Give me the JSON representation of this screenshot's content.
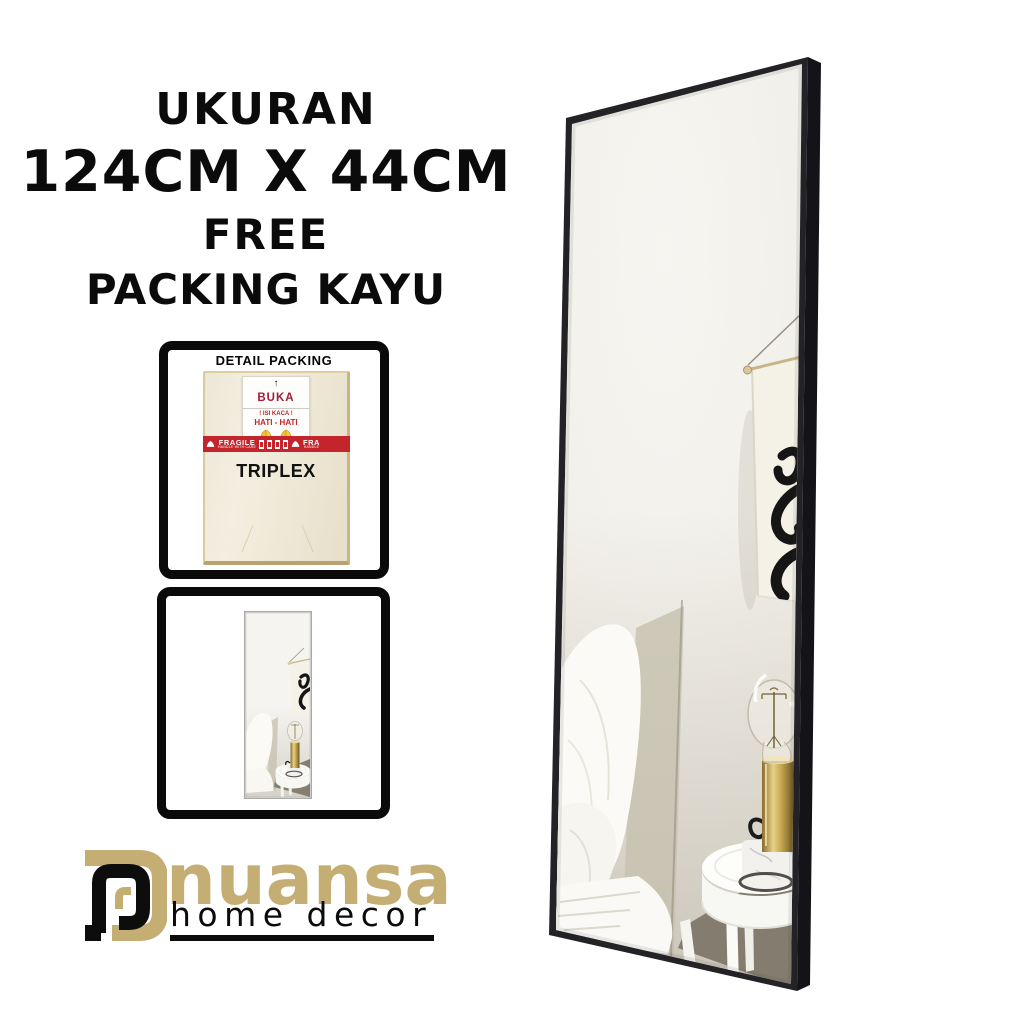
{
  "header": {
    "lines": [
      "UKURAN",
      "124CM X 44CM",
      "FREE",
      "PACKING KAYU"
    ]
  },
  "packing_box": {
    "title": "DETAIL PACKING",
    "label": {
      "arrow": "↑",
      "title": "BUKA",
      "warning_line1": "! ISI KACA !",
      "warning_line2": "HATI - HATI"
    },
    "tape": {
      "text": "FRAGILE",
      "subtext": "HANDLE WITH CARE",
      "repeat_text": "FRA",
      "repeat_subtext": "HANDLE"
    },
    "material_text": "TRIPLEX"
  },
  "logo": {
    "brand": "nuansa",
    "tagline": "home decor"
  },
  "icons": {
    "arrow_up": "arrow-up",
    "praying_hands": "praying-hands"
  },
  "colors": {
    "background": "#FFFFFF",
    "text_black": "#0B0B0B",
    "mirror_frame": "#232327",
    "mirror_wall": "#F2F0EA",
    "logo_gold": "#C4AE74",
    "tape_red": "#C4242B",
    "label_red": "#C3242B",
    "buka_maroon": "#A01C38",
    "hands_yellow": "#F1C12F",
    "brass_lamp": "#B08F3F",
    "plywood_cream": "#EFE9D8"
  }
}
